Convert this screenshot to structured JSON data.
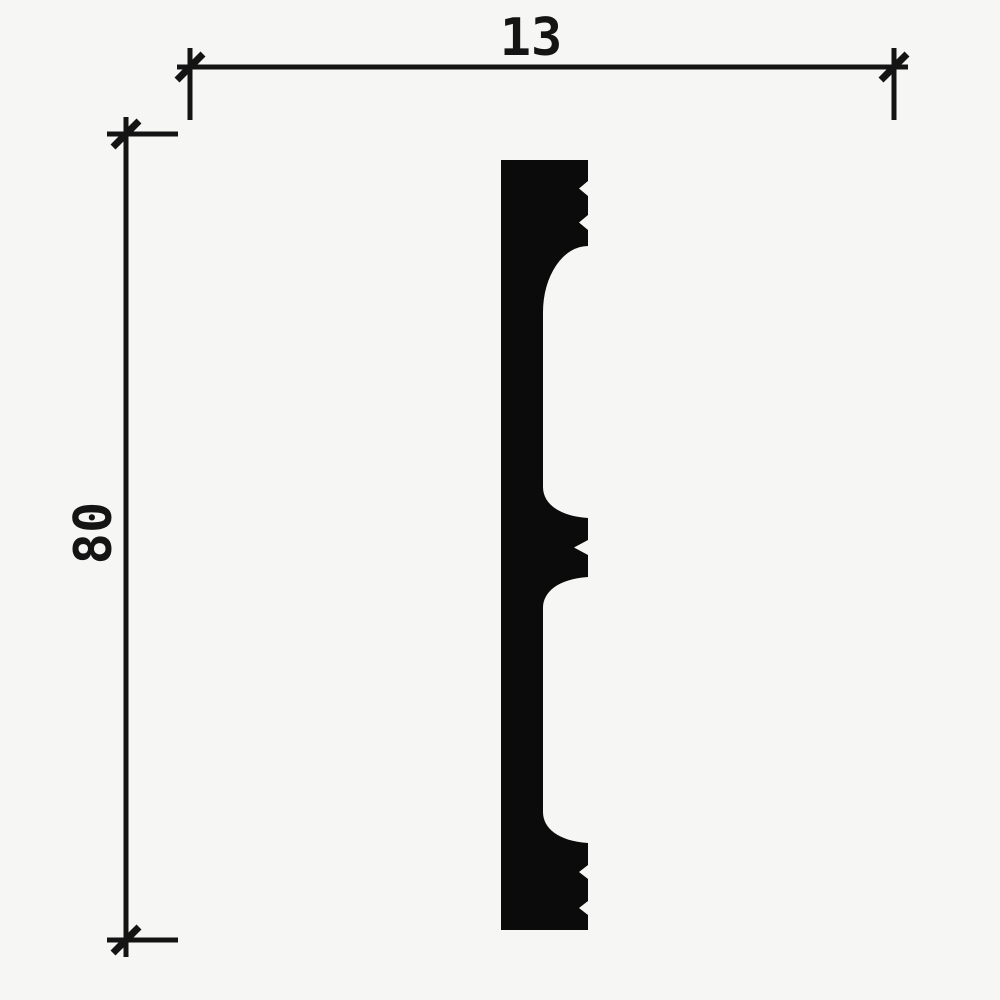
{
  "drawing": {
    "background_color": "#f6f6f4",
    "line_color": "#141414",
    "shape_color": "#0b0b0b",
    "dimensions": {
      "width_label": "13",
      "height_label": "80"
    }
  }
}
